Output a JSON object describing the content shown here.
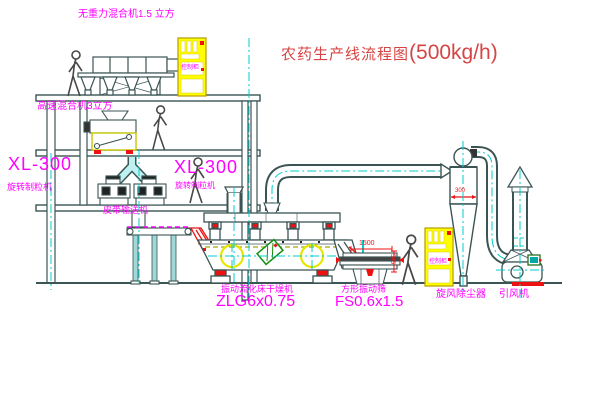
{
  "title": {
    "prefix": "农药生产线流程图",
    "capacity": "(500kg/h)"
  },
  "labels": {
    "gravity_mixer": "无重力混合机1.5 立方",
    "high_speed_mixer": "高速混合机3立方",
    "granulator_left_model": "XL-300",
    "granulator_left_name": "旋转制粒机",
    "granulator_right_model": "XL-300",
    "granulator_right_name": "旋转制粒机",
    "belt_conveyor": "皮带输送机",
    "dryer_name": "振动流化床干燥机",
    "dryer_model": "ZLG6x0.75",
    "sieve_name": "方形振动筛",
    "sieve_model": "FS0.6x1.5",
    "cyclone": "旋风除尘器",
    "fan": "引风机",
    "cabinet_top": "控制柜",
    "cabinet_right": "控制柜"
  },
  "dimensions": {
    "sieve_width": "1500",
    "sieve_height": "545",
    "cyclone_mark": "300"
  },
  "colors": {
    "line": "#3b5454",
    "centerline": "#00cccc",
    "label_magenta": "#ff00ff",
    "title_red": "#d54545",
    "dimension_red": "#ee1111",
    "cabinet_yellow": "#ffff00",
    "motor_green": "#109010",
    "chute_cyan": "#bff0f0"
  }
}
